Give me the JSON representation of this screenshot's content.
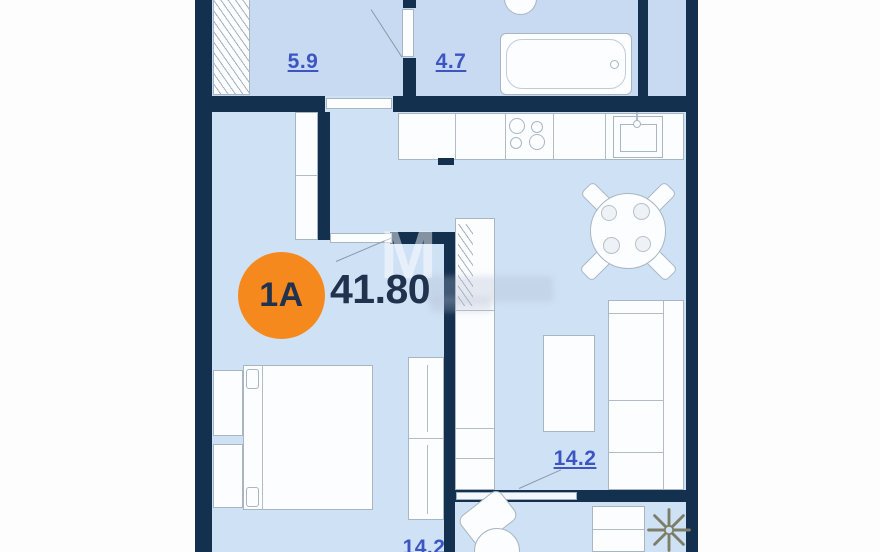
{
  "plan": {
    "unit_badge": "1A",
    "total_area": "41.80",
    "watermark_letter": "М",
    "rooms": [
      {
        "name": "hallway",
        "label": "5.9"
      },
      {
        "name": "bathroom",
        "label": "4.7"
      },
      {
        "name": "kitchen-living-room",
        "label": "14.2"
      },
      {
        "name": "bedroom",
        "label": "14.2"
      }
    ],
    "colors": {
      "wall": "#14304f",
      "floor_upper_rooms": "#c7daf1",
      "floor_main": "#cfe1f5",
      "badge_orange": "#f6891e",
      "room_label_blue": "#3c55c2",
      "area_text_navy": "#21324f",
      "furniture_stroke": "#a9b5c1",
      "snowflake_gray": "#7c7e67"
    },
    "icons": {
      "snowflake": "✳"
    }
  }
}
